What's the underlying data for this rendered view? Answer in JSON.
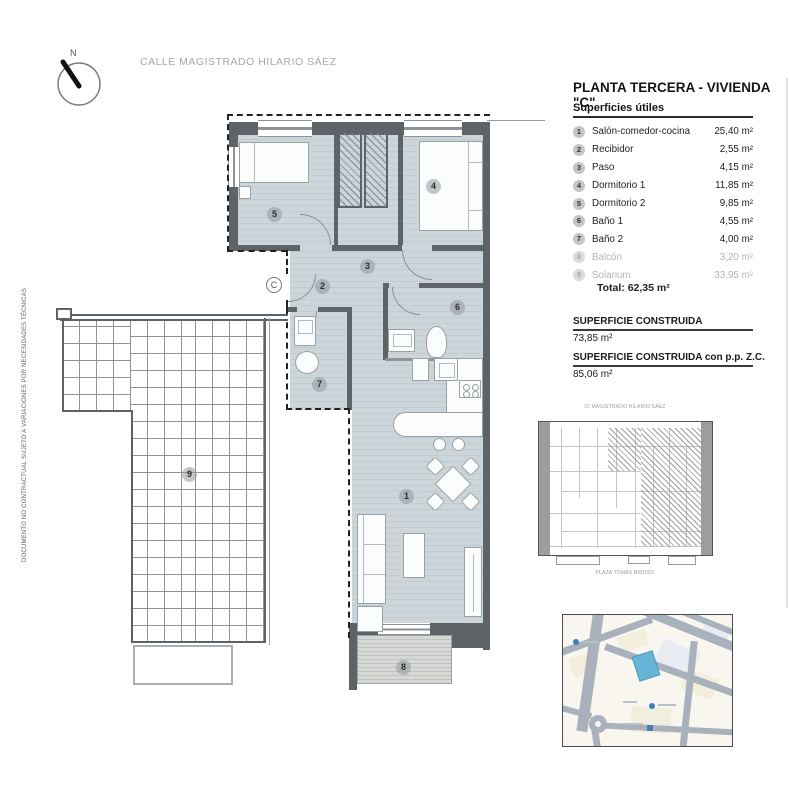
{
  "header": {
    "north_label": "N",
    "street_label": "CALLE MAGISTRADO HILARIO SÁEZ"
  },
  "side_note": "DOCUMENTO NO CONTRACTUAL SUJETO A VARIACIONES POR NECESIDADES TÉCNICAS",
  "title": "PLANTA TERCERA - VIVIENDA \"C\"",
  "surfaces": {
    "heading": "Superficies útiles",
    "rows": [
      {
        "num": "1",
        "name": "Salón-comedor-cocina",
        "value": "25,40 m²"
      },
      {
        "num": "2",
        "name": "Recibidor",
        "value": "2,55 m²"
      },
      {
        "num": "3",
        "name": "Paso",
        "value": "4,15 m²"
      },
      {
        "num": "4",
        "name": "Dormitorio 1",
        "value": "11,85 m²"
      },
      {
        "num": "5",
        "name": "Dormitorio 2",
        "value": "9,85 m²"
      },
      {
        "num": "6",
        "name": "Baño 1",
        "value": "4,55 m²"
      },
      {
        "num": "7",
        "name": "Baño 2",
        "value": "4,00 m²"
      },
      {
        "num": "8",
        "name": "Balcón",
        "value": "3,20 m²"
      },
      {
        "num": "9",
        "name": "Solarium",
        "value": "33,95 m²"
      }
    ],
    "total": "Total: 62,35 m²"
  },
  "built": {
    "label_1": "SUPERFICIE CONSTRUIDA",
    "value_1": "73,85 m²",
    "label_2": "SUPERFICIE CONSTRUIDA con p.p. Z.C.",
    "value_2": "85,06 m²"
  },
  "plan": {
    "unit_letter": "C",
    "labels": {
      "1": "1",
      "2": "2",
      "3": "3",
      "4": "4",
      "5": "5",
      "6": "6",
      "7": "7",
      "8": "8",
      "9": "9"
    }
  },
  "keyplan": {
    "street_top": "C/ MAGISTRADO HILARIO SÁEZ",
    "street_bottom": "PLAZA TOMÁS BRIOSO"
  },
  "colors": {
    "floor": "#ccd5d9",
    "wall": "#5d6367",
    "muted_row": "#b2b5b7",
    "map_parcel": "#66b5d6"
  }
}
